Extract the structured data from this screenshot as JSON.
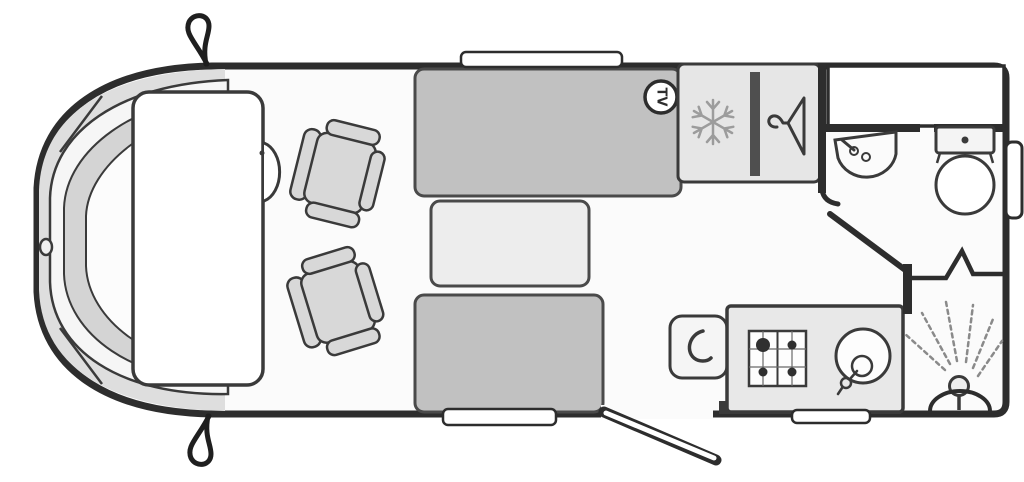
{
  "diagram": {
    "type": "motorhome-floorplan",
    "badges": {
      "tv": "TV"
    },
    "icons": {
      "snowflake": "fridge-freezer",
      "hanger": "wardrobe",
      "shower_spray": "shower",
      "hob": "four-burner-hob",
      "mirror": "wing-mirror"
    },
    "fixtures": [
      "cab-bed",
      "swivel-seat-front",
      "swivel-seat-rear",
      "sofa-bench-top",
      "dinette-table",
      "sofa-bench-bottom",
      "tv-point",
      "fridge-freezer",
      "wardrobe",
      "washroom-basin",
      "toilet",
      "kitchen-worktop",
      "hob",
      "kitchen-sink",
      "shower-cubicle",
      "entrance-door"
    ],
    "colors": {
      "wall": "#2d2d2d",
      "line": "#3a3a3a",
      "floor": "#fbfbfb",
      "bench": "#c1c1c1",
      "table": "#ededed",
      "panel": "#e6e6e6",
      "counter": "#e8e8e8",
      "seat": "#d8d8d8",
      "cabZone": "#dedede",
      "dash": "#d4d4d4",
      "divider": "#4f4f4f",
      "iconGray": "#9c9c9c",
      "white": "#ffffff"
    }
  }
}
